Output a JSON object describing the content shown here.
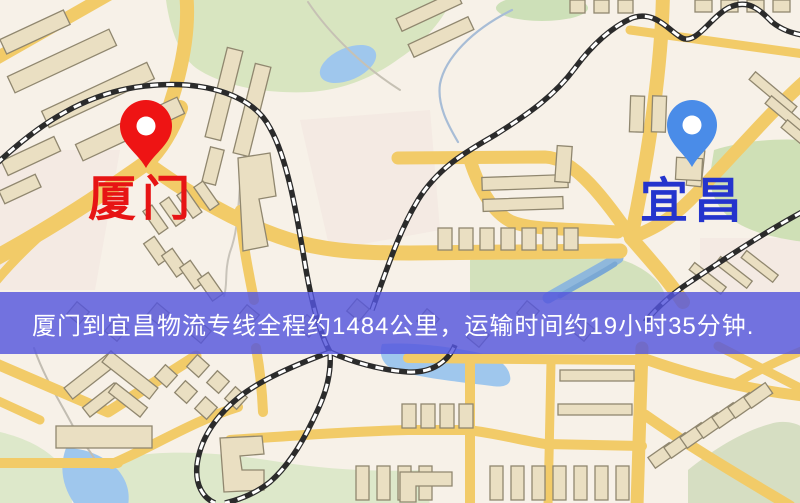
{
  "banner": {
    "text": "厦门到宜昌物流专线全程约1484公里，运输时间约19小时35分钟."
  },
  "route": {
    "origin": "厦门",
    "destination": "宜昌",
    "distance_text": "约1484公里",
    "duration_text": "约19小时35分钟"
  },
  "map": {
    "markers": [
      {
        "name": "origin",
        "label": "厦门",
        "pin_color": "#ee1414",
        "label_color": "#e71414"
      },
      {
        "name": "destination",
        "label": "宜昌",
        "pin_color": "#4a8ce8",
        "label_color": "#2434cd"
      }
    ]
  },
  "colors": {
    "banner_bg": "#5456dd",
    "banner_text": "#ffffff",
    "map_bg": "#f7f1e8",
    "road": "#f2cb68",
    "building": "#eadfc2",
    "building_outline": "#90876f",
    "park": "#d8e5c0",
    "water": "#9fc7ed",
    "railway": "#2b2b2b"
  }
}
